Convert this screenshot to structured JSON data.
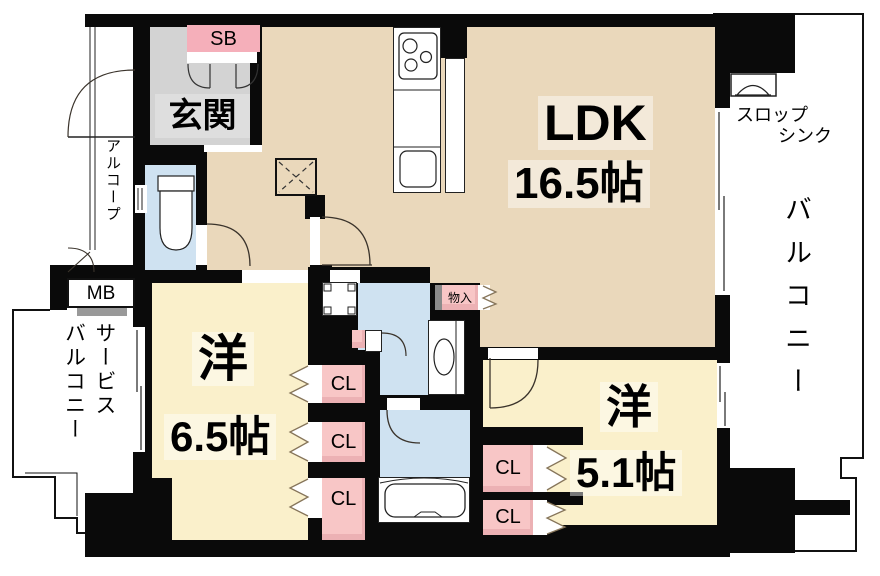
{
  "floorplan": {
    "type": "japanese-apartment-floorplan",
    "rooms": {
      "ldk": {
        "name": "LDK",
        "area": "16.5帖"
      },
      "bedroom_65": {
        "name": "洋",
        "area": "6.5帖"
      },
      "bedroom_51": {
        "name": "洋",
        "area": "5.1帖"
      },
      "entrance": {
        "label": "玄関"
      }
    },
    "labels": {
      "shoe_box": "SB",
      "meter_box": "MB",
      "closet": "CL",
      "storage": "物入",
      "alcove": "アルコープ",
      "balcony": "バルコニー",
      "service_balcony_line1": "サービス",
      "service_balcony_line2": "バルコニー",
      "slop_sink_line1": "スロップ",
      "slop_sink_line2": "シンク"
    },
    "colors": {
      "wall": "#0a0a0a",
      "ldk_floor": "#ead8bb",
      "bedroom_floor": "#faf0cb",
      "wet_area_floor": "#cfe2f1",
      "entrance_floor": "#d3d3d3",
      "closet_pink": "#f8c6c6",
      "shoebox_pink": "#f5afba",
      "outside": "#ffffff"
    }
  }
}
